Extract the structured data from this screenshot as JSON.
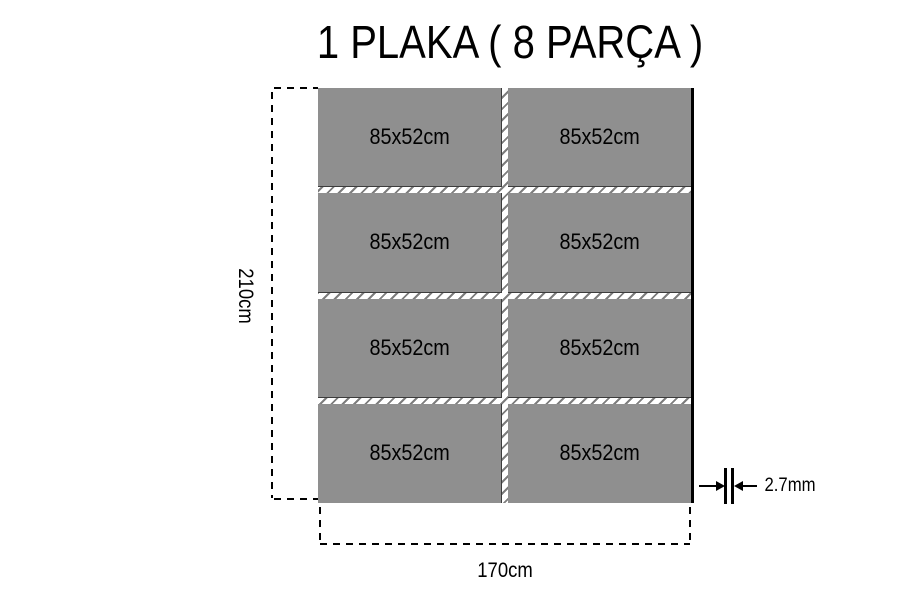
{
  "title": "1 PLAKA ( 8 PARÇA )",
  "pieces": [
    {
      "label": "85x52cm"
    },
    {
      "label": "85x52cm"
    },
    {
      "label": "85x52cm"
    },
    {
      "label": "85x52cm"
    },
    {
      "label": "85x52cm"
    },
    {
      "label": "85x52cm"
    },
    {
      "label": "85x52cm"
    },
    {
      "label": "85x52cm"
    }
  ],
  "dims": {
    "height": "210cm",
    "width": "170cm",
    "thickness": "2.7mm"
  },
  "colors": {
    "piece-fill": "#8f8f8f",
    "piece-edge": "#3c3c3c",
    "plate-edge": "#000000",
    "cut-tick": "#7d7d7d",
    "ink": "#000000",
    "background": "#ffffff"
  }
}
